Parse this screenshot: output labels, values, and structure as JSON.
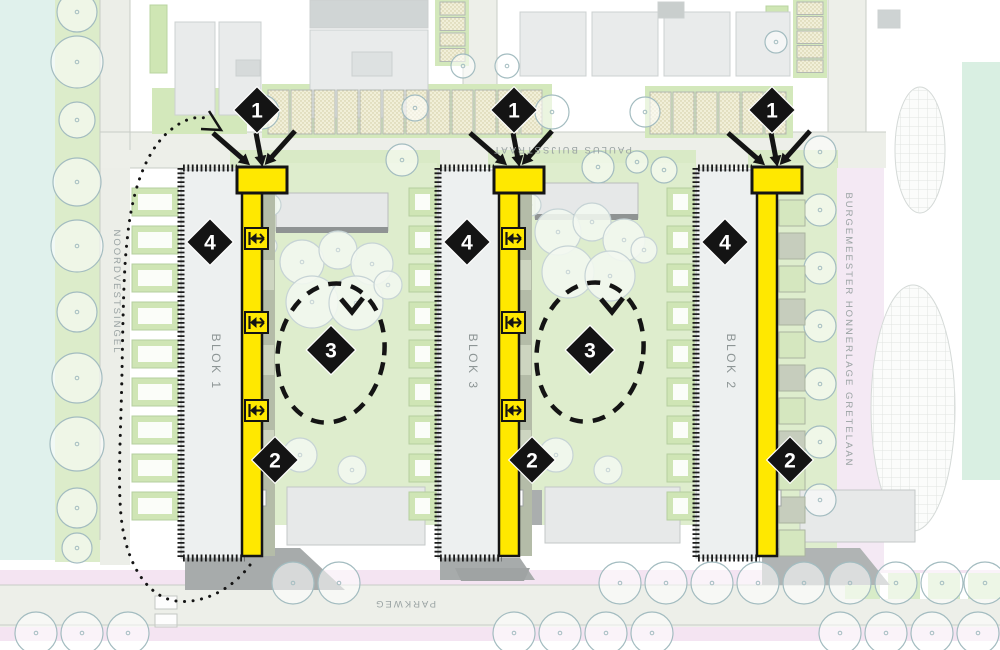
{
  "plan": {
    "streets": {
      "north": "PAULUS BUIJSSTRAAT",
      "west": "NOORDVESTSINGEL",
      "east": "BURGEMEESTER HONNERLAGE GRETELAAN",
      "south": "PARKWEG"
    },
    "blocks": {
      "left": "BLOK 1",
      "middle": "BLOK 3",
      "right": "BLOK 2"
    },
    "markers": {
      "one": "1",
      "two": "2",
      "three": "3",
      "four": "4"
    },
    "colors": {
      "accent_yellow": "#ffe800",
      "marker_black": "#141414",
      "courtyard_green": "#deedcd",
      "street_pink": "#f4e4f2",
      "water_cyan": "#e0f1ec",
      "building_gray": "#e9ebeb"
    }
  }
}
